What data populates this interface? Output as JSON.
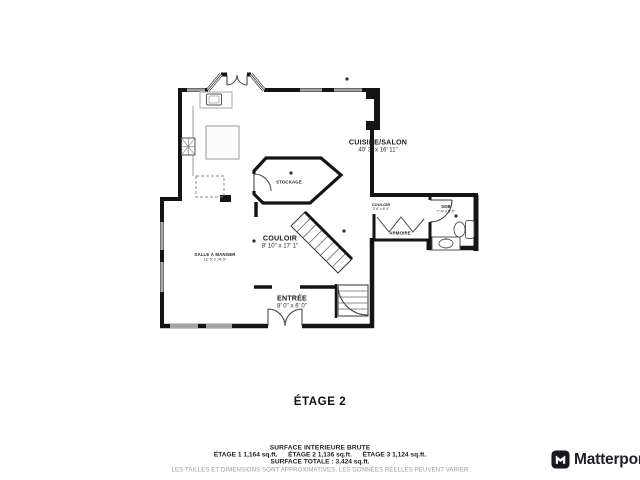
{
  "floor": {
    "title": "ÉTAGE 2"
  },
  "rooms": {
    "cuisine_salon": {
      "name": "CUISINE/SALON",
      "dims": "40' 3\" x 16' 11\""
    },
    "stockage": {
      "name": "STOCKAGE",
      "dims": ""
    },
    "couloir": {
      "name": "COULOIR",
      "dims": "8' 10\" x 17' 1\""
    },
    "salle_a_manger": {
      "name": "SALLE À MANGER",
      "dims": "12' 5\" x 14' 9\""
    },
    "entree": {
      "name": "ENTRÉE",
      "dims": "8' 0\" x 6' 0\""
    },
    "couloir_2": {
      "name": "COULOIR",
      "dims": "3' 6\" x 8' 4\""
    },
    "armoire": {
      "name": "ARMOIRE",
      "dims": ""
    },
    "sdb": {
      "name": "SDB",
      "dims": "7' 4\" x 5' 0\""
    }
  },
  "footer": {
    "surface_title": "SURFACE INTERIEURE BRUTE",
    "floors": [
      {
        "label": "ÉTAGE 1 1,164 sq.ft."
      },
      {
        "label": "ÉTAGE 2 1,136 sq.ft."
      },
      {
        "label": "ÉTAGE 3 1,124 sq.ft."
      }
    ],
    "total": "SURFACE TOTALE :  3,424 sq.ft.",
    "disclaimer": "LES TAILLES ET DIMENSIONS SONT APPROXIMATIVES, LES DONNÉES RÉELLES PEUVENT VARIER"
  },
  "branding": {
    "name": "Matterport"
  },
  "colors": {
    "wall": "#141414",
    "muted_text": "#9b9b9b"
  }
}
